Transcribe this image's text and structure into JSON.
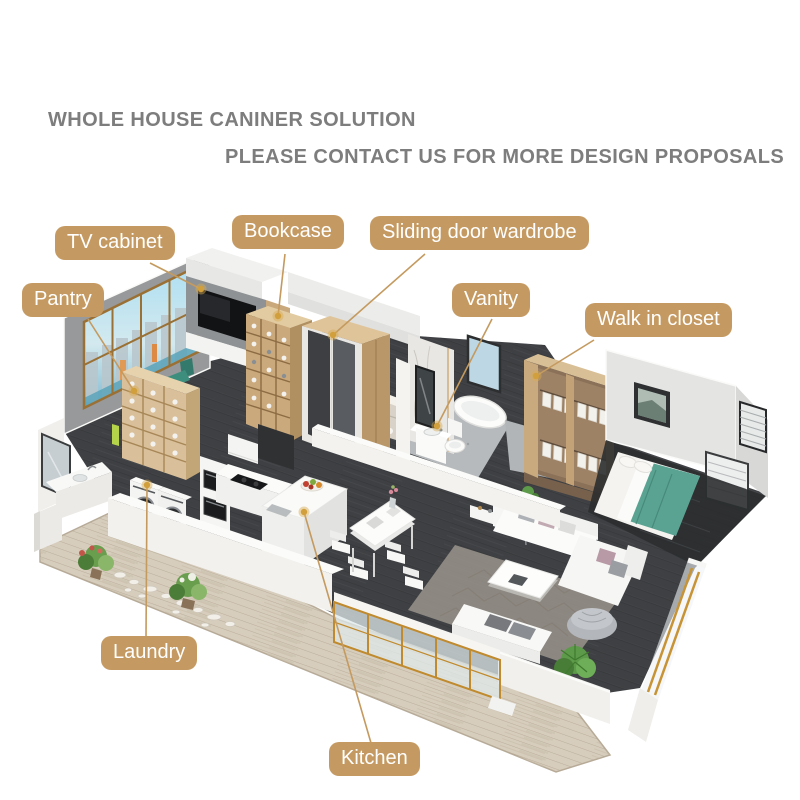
{
  "scene": "3D isometric cutaway rendering of an apartment interior with labeled cabinetry zones",
  "header": {
    "line1": "WHOLE HOUSE CANINER SOLUTION",
    "line2": "PLEASE CONTACT US FOR MORE DESIGN PROPOSALS"
  },
  "callouts": [
    {
      "text": "TV cabinet"
    },
    {
      "text": "Bookcase"
    },
    {
      "text": "Sliding door wardrobe"
    },
    {
      "text": "Pantry"
    },
    {
      "text": "Vanity"
    },
    {
      "text": "Walk in closet"
    },
    {
      "text": "Laundry"
    },
    {
      "text": "Kitchen"
    }
  ],
  "colors": {
    "label_background": "#c59a62",
    "label_text": "#ffffff",
    "leader_line": "#c49a5f",
    "leader_dot": "#d29f3d",
    "header_text": "#7d7d7d",
    "floor_dark": "#3e4043",
    "balcony_wood": "#d7cdbd",
    "wall_white": "#f2f1ee",
    "wood_furniture": "#caa97c",
    "accent_teal": "#5aa392",
    "window_sky": "#aedff2",
    "gold_frame": "#c08a2e"
  }
}
